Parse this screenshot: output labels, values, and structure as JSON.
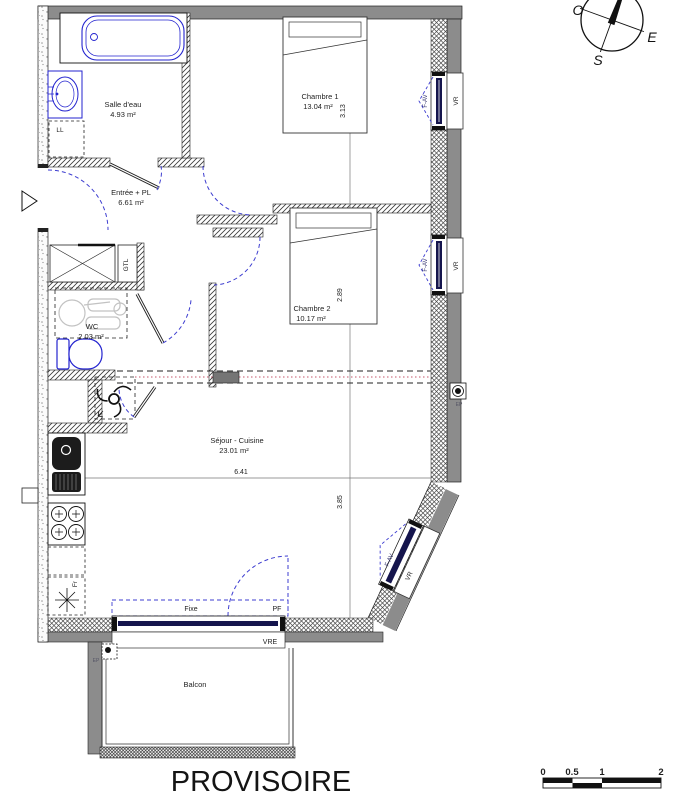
{
  "watermark": "PROVISOIRE",
  "rooms": {
    "salle_deau": {
      "name": "Salle d'eau",
      "area": "4.93 m²"
    },
    "entree": {
      "name": "Entrée + PL",
      "area": "6.61 m²"
    },
    "chambre1": {
      "name": "Chambre 1",
      "area": "13.04 m²"
    },
    "chambre2": {
      "name": "Chambre 2",
      "area": "10.17 m²"
    },
    "wc": {
      "name": "WC",
      "area": "2.03 m²"
    },
    "sejour": {
      "name": "Séjour - Cuisine",
      "area": "23.01 m²"
    },
    "balcon": {
      "name": "Balcon"
    }
  },
  "dimensions": {
    "chambre1_depth": "3.13",
    "chambre2_depth": "2.89",
    "sejour_width": "6.41",
    "sejour_depth": "3.85"
  },
  "labels": {
    "washing_machine": "LL",
    "technical_duct": "GTL",
    "fridge": "Fr",
    "roller_shutter": "VR",
    "window_fav": "F-AV",
    "fixed_pane": "Fixe",
    "french_window": "PF",
    "shutter_vre": "VRE",
    "rainwater": "EP"
  },
  "compass": {
    "west": "O",
    "east": "E",
    "south": "S"
  },
  "scale_bar": {
    "ticks": [
      "0",
      "0.5",
      "1",
      "2"
    ]
  },
  "colors": {
    "wall_gray": "#8c8c8c",
    "fixture_blue": "#2323cf",
    "door_swing_blue": "#3d3dd0",
    "partition_red": "#c4556a"
  }
}
